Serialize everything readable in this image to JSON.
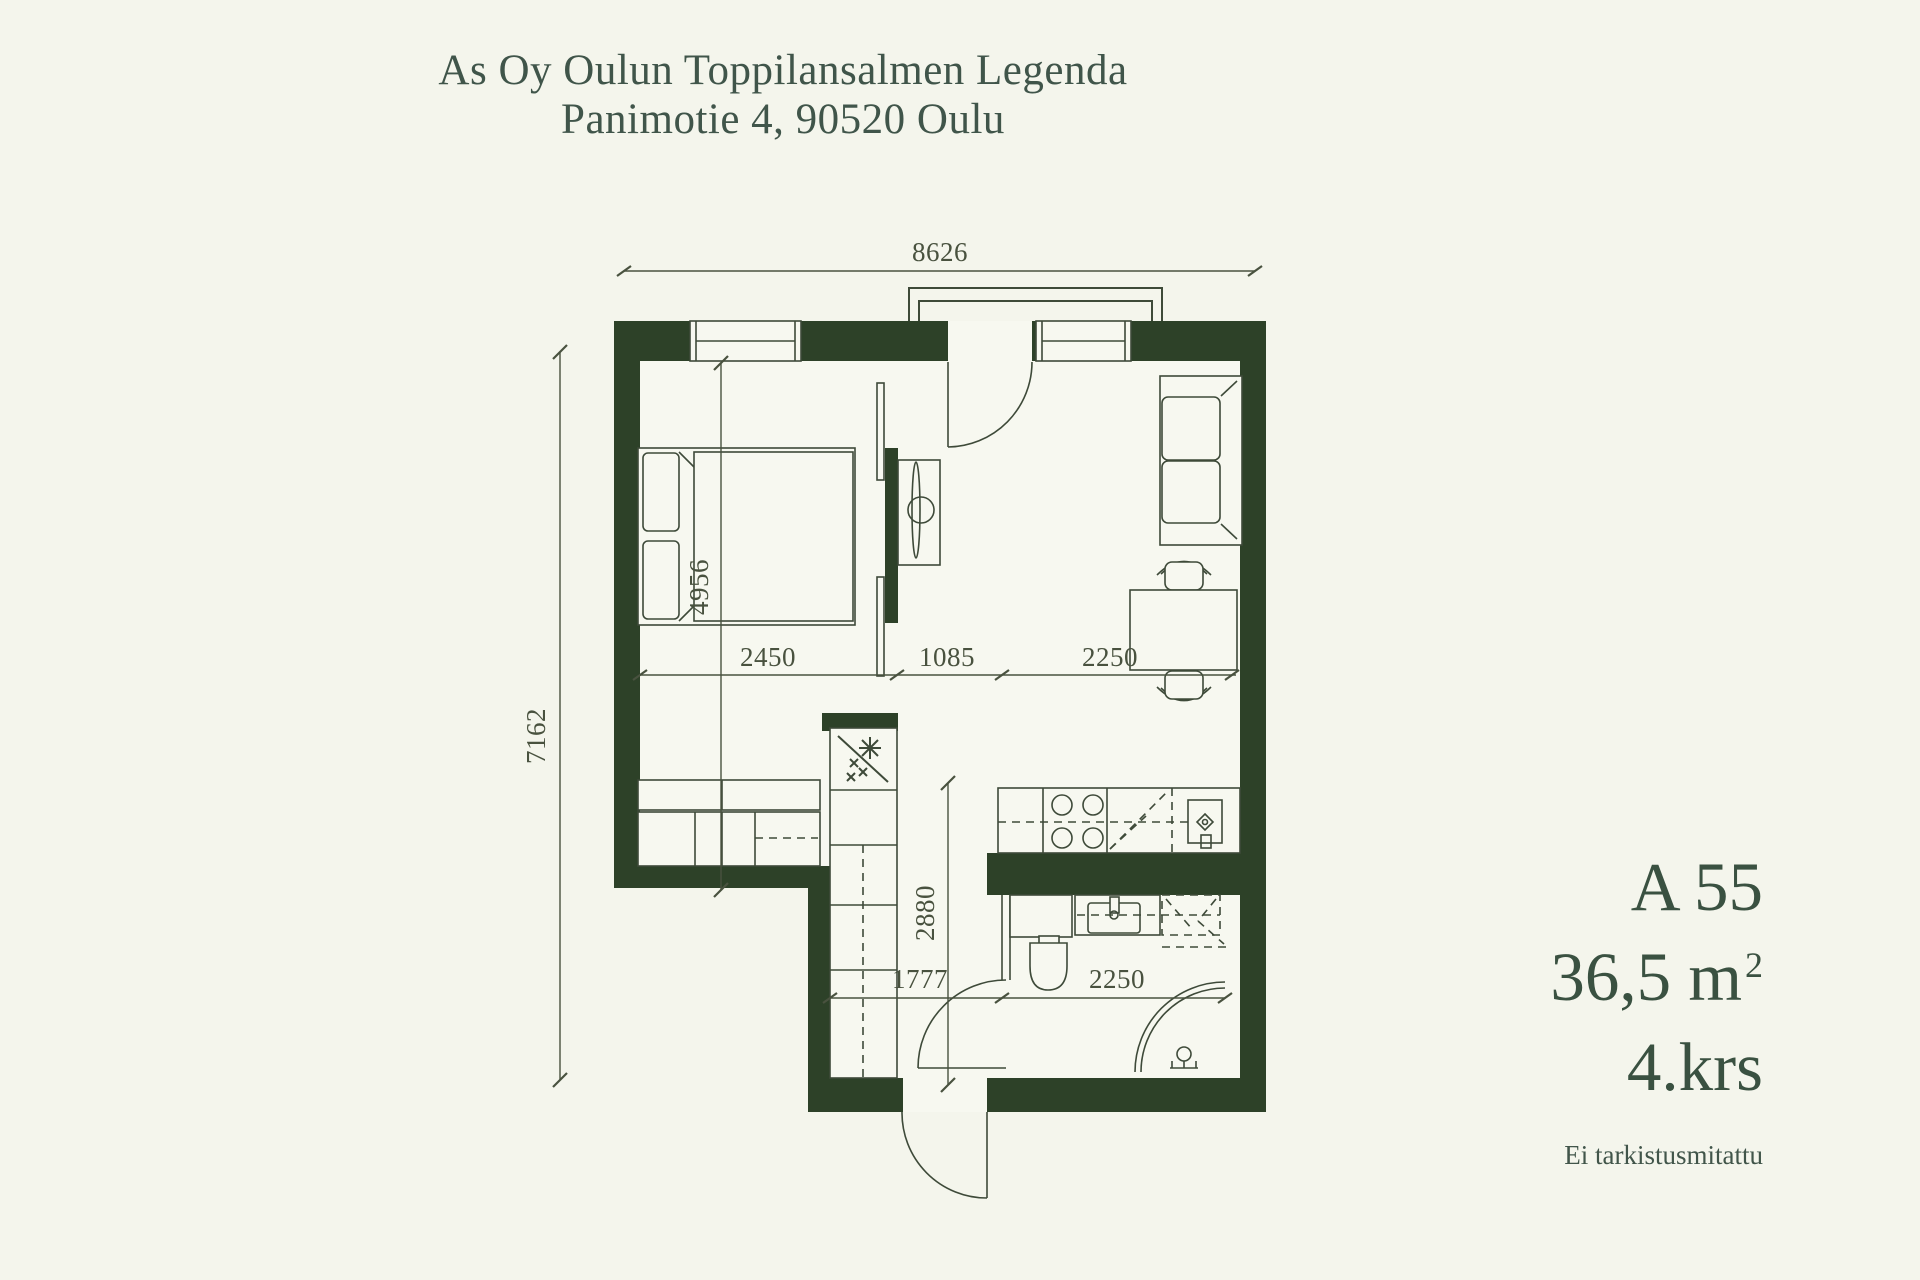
{
  "title": {
    "line1": "As Oy Oulun Toppilansalmen Legenda",
    "line2": "Panimotie 4, 90520 Oulu"
  },
  "apartment": {
    "unit": "A 55",
    "area_value": "36,5 m",
    "area_superscript": "2",
    "floor": "4.krs",
    "note": "Ei tarkistusmitattu"
  },
  "dimensions": {
    "top_width": "8626",
    "left_height": "7162",
    "bedroom_height": "4956",
    "bedroom_width": "2450",
    "mid_width": "1085",
    "living_width": "2250",
    "hall_height": "2880",
    "hall_width": "1777",
    "bath_width": "2250"
  },
  "colors": {
    "background": "#f4f5ec",
    "wall_green": "#2d4128",
    "line": "#3e4a39",
    "text": "#40554a"
  }
}
